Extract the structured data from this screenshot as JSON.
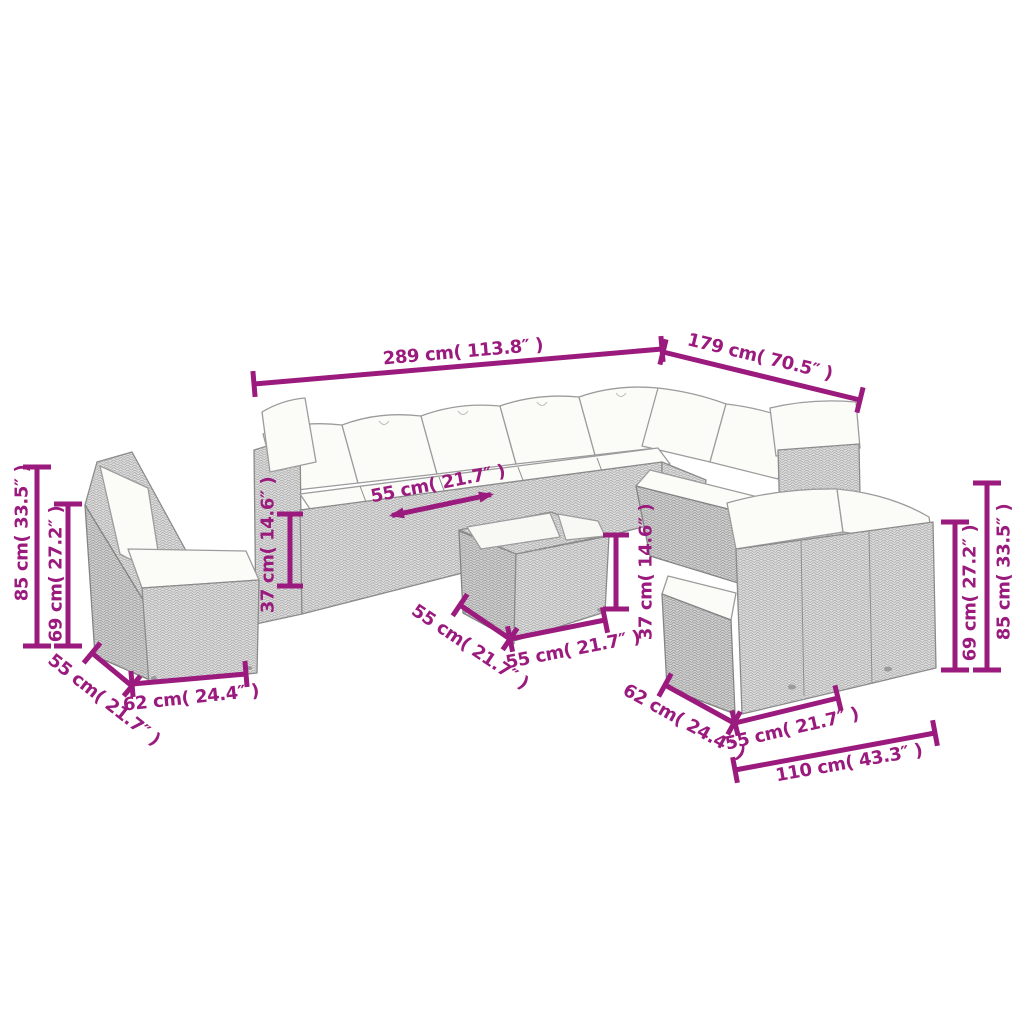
{
  "figure": {
    "description": "Line-art dimension diagram of a poly rattan garden lounge furniture set",
    "pieces": [
      "corner-sofa",
      "armless-chair",
      "coffee-table",
      "two-seater-bench"
    ]
  },
  "colors": {
    "accent": "#9b1a7d",
    "line_art": "#8b8b8b",
    "wicker_fill": "#dbdbdb",
    "cushion_fill": "#fbfbf8",
    "background": "#ffffff"
  },
  "dims": [
    {
      "id": "sofa-width",
      "text": "289 cm( 113.8″ )"
    },
    {
      "id": "sofa-depth",
      "text": "179 cm( 70.5″ )"
    },
    {
      "id": "chair-total-height",
      "text": "85 cm( 33.5″ )"
    },
    {
      "id": "chair-back-height",
      "text": "69 cm( 27.2″ )"
    },
    {
      "id": "seat-width",
      "text": "55 cm( 21.7″ )"
    },
    {
      "id": "chair-seat-height",
      "text": "37 cm( 14.6″ )"
    },
    {
      "id": "table-height",
      "text": "37 cm( 14.6″ )"
    },
    {
      "id": "chair-depth",
      "text": "55 cm( 21.7″ )"
    },
    {
      "id": "chair-width",
      "text": "62 cm( 24.4″ )"
    },
    {
      "id": "table-depth",
      "text": "55 cm( 21.7″ )"
    },
    {
      "id": "table-width",
      "text": "55 cm( 21.7″ )"
    },
    {
      "id": "bench-back-height",
      "text": "69 cm( 27.2″ )"
    },
    {
      "id": "bench-total-height",
      "text": "85 cm( 33.5″ )"
    },
    {
      "id": "bench-depth",
      "text": "62 cm( 24.4″ )"
    },
    {
      "id": "bench-seat-width",
      "text": "55 cm( 21.7″ )"
    },
    {
      "id": "bench-width",
      "text": "110 cm( 43.3″ )"
    }
  ]
}
